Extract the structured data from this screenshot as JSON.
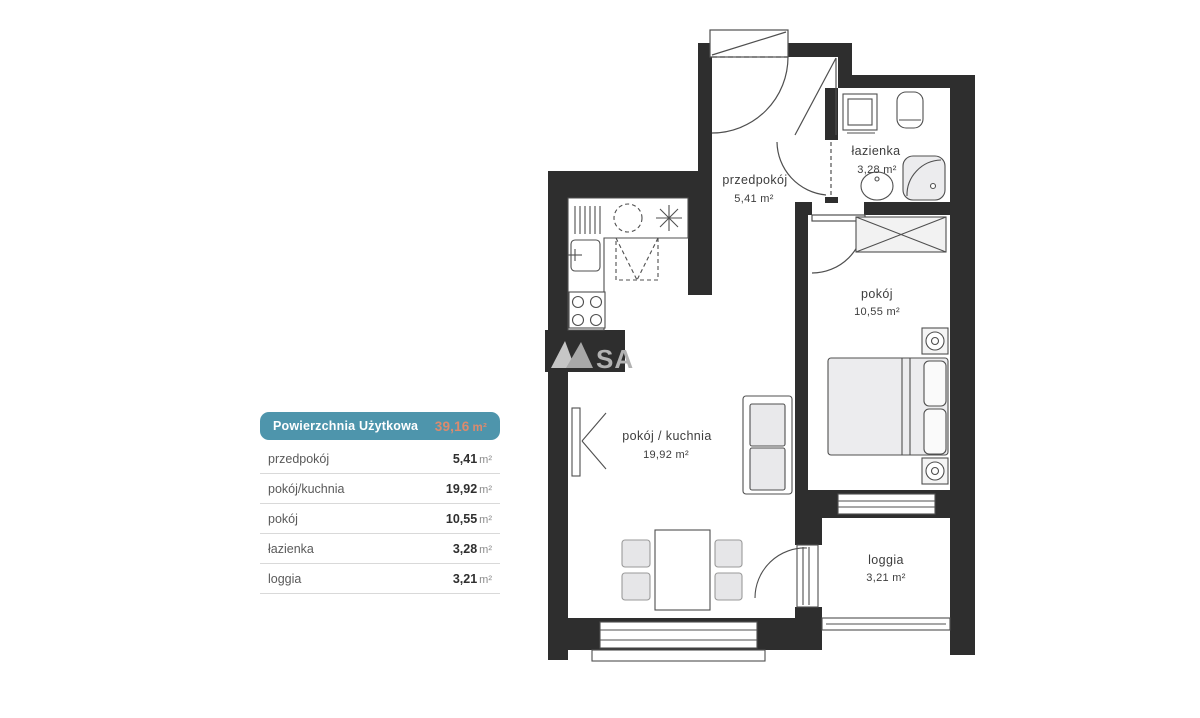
{
  "legend": {
    "header": {
      "title": "Powierzchnia Użytkowa",
      "value": "39,16",
      "unit": "m²"
    },
    "rows": [
      {
        "label": "przedpokój",
        "value": "5,41",
        "unit": "m²"
      },
      {
        "label": "pokój/kuchnia",
        "value": "19,92",
        "unit": "m²"
      },
      {
        "label": "pokój",
        "value": "10,55",
        "unit": "m²"
      },
      {
        "label": "łazienka",
        "value": "3,28",
        "unit": "m²"
      },
      {
        "label": "loggia",
        "value": "3,21",
        "unit": "m²"
      }
    ],
    "colors": {
      "header_bg": "#4e95ac",
      "header_text": "#ffffff",
      "value_accent": "#dd8a6d"
    }
  },
  "floor_plan": {
    "rooms": [
      {
        "id": "przedpokoj",
        "name": "przedpokój",
        "area": "5,41 m²"
      },
      {
        "id": "pokoj-kuchnia",
        "name": "pokój / kuchnia",
        "area": "19,92 m²"
      },
      {
        "id": "pokoj",
        "name": "pokój",
        "area": "10,55 m²"
      },
      {
        "id": "lazienka",
        "name": "łazienka",
        "area": "3,28 m²"
      },
      {
        "id": "loggia",
        "name": "loggia",
        "area": "3,21 m²"
      }
    ],
    "watermark": {
      "text": "SA"
    },
    "colors": {
      "wall": "#2e2e2e",
      "furniture_stroke": "#4f4f4f",
      "furniture_fill": "#ececee",
      "watermark": "#b2b2b2"
    }
  }
}
